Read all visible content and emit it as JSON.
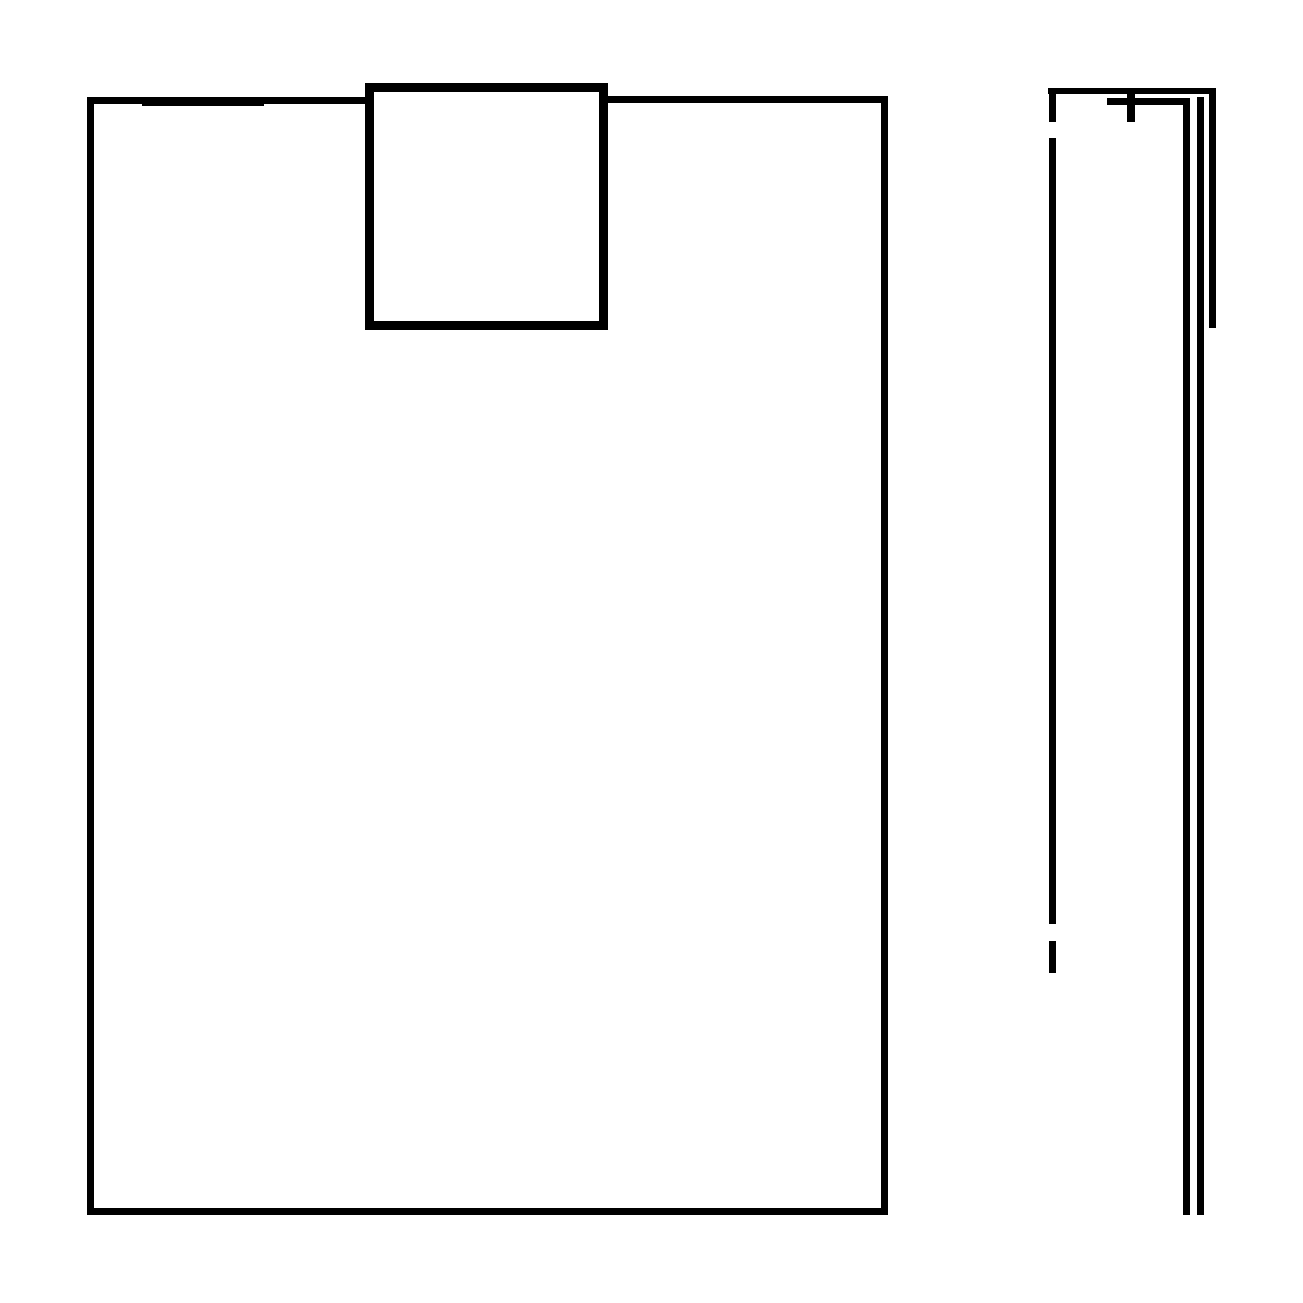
{
  "canvas": {
    "width": 1303,
    "height": 1303,
    "background_color": "#ffffff",
    "stroke_color": "#000000"
  },
  "figures": [
    {
      "name": "document-outline",
      "description": "large rectangle outline with a white-filled square notch overlapping its top edge"
    },
    {
      "name": "side-line-cluster",
      "description": "tall narrow corner structure: dashed left vertical, top bar, cross tick, inner bar and three nested vertical lines of different lengths"
    }
  ],
  "shapes": [
    {
      "name": "doc-left-edge",
      "type": "bar",
      "x": 87,
      "y": 97,
      "w": 7,
      "h": 1118
    },
    {
      "name": "doc-top-edge-left",
      "type": "bar",
      "x": 87,
      "y": 97,
      "w": 283,
      "h": 7
    },
    {
      "name": "doc-top-edge-left-stroke2",
      "type": "bar",
      "x": 142,
      "y": 100,
      "w": 122,
      "h": 6
    },
    {
      "name": "doc-top-edge-right",
      "type": "bar",
      "x": 604,
      "y": 96,
      "w": 284,
      "h": 7
    },
    {
      "name": "doc-right-edge",
      "type": "bar",
      "x": 881,
      "y": 96,
      "w": 7,
      "h": 1119
    },
    {
      "name": "doc-bottom-edge",
      "type": "bar",
      "x": 87,
      "y": 1208,
      "w": 801,
      "h": 7
    },
    {
      "name": "notch-square",
      "type": "rect",
      "x": 365,
      "y": 83,
      "w": 243,
      "h": 247,
      "stroke": 9
    },
    {
      "name": "side-top-edge",
      "type": "bar",
      "x": 1048,
      "y": 88,
      "w": 168,
      "h": 6
    },
    {
      "name": "side-dash-top",
      "type": "bar",
      "x": 1049,
      "y": 88,
      "w": 7,
      "h": 34
    },
    {
      "name": "side-dash-middle",
      "type": "bar",
      "x": 1049,
      "y": 138,
      "w": 7,
      "h": 786
    },
    {
      "name": "side-dash-bottom",
      "type": "bar",
      "x": 1049,
      "y": 941,
      "w": 7,
      "h": 32
    },
    {
      "name": "side-cross-tick",
      "type": "bar",
      "x": 1127,
      "y": 88,
      "w": 8,
      "h": 34
    },
    {
      "name": "side-inner-bar",
      "type": "bar",
      "x": 1107,
      "y": 98,
      "w": 83,
      "h": 7
    },
    {
      "name": "side-vertical-inner",
      "type": "bar",
      "x": 1183,
      "y": 98,
      "w": 7,
      "h": 1117
    },
    {
      "name": "side-vertical-middle",
      "type": "bar",
      "x": 1197,
      "y": 97,
      "w": 7,
      "h": 1118
    },
    {
      "name": "side-vertical-outer",
      "type": "bar",
      "x": 1209,
      "y": 88,
      "w": 7,
      "h": 240
    }
  ]
}
